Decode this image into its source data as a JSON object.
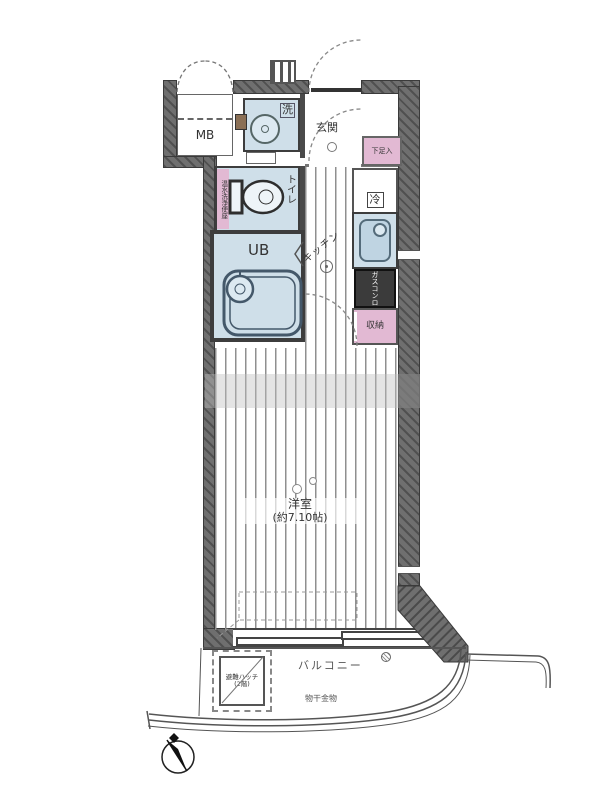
{
  "plan": {
    "rooms": {
      "mb": "MB",
      "laundry": "洗",
      "entrance": "玄関",
      "shoe_box": "下足入",
      "fridge": "冷",
      "toilet": "トイレ",
      "washlet": "温水洗浄便座",
      "bath": "UB",
      "kitchen": "キッチン",
      "stove": "ガスコンロ",
      "storage": "収納",
      "main_room": "洋室",
      "main_room_size": "(約7.10帖)",
      "balcony": "バルコニー",
      "laundry_pole": "物干金物",
      "hatch_line1": "避難ハッチ",
      "hatch_line2": "(2階)"
    },
    "colors": {
      "wall": "#6f6f6f",
      "room_blue": "#cfdfe9",
      "pink": "#e2b9d3",
      "stove_dark": "#3b3b3b",
      "stripe": "#8f8f8f"
    }
  }
}
